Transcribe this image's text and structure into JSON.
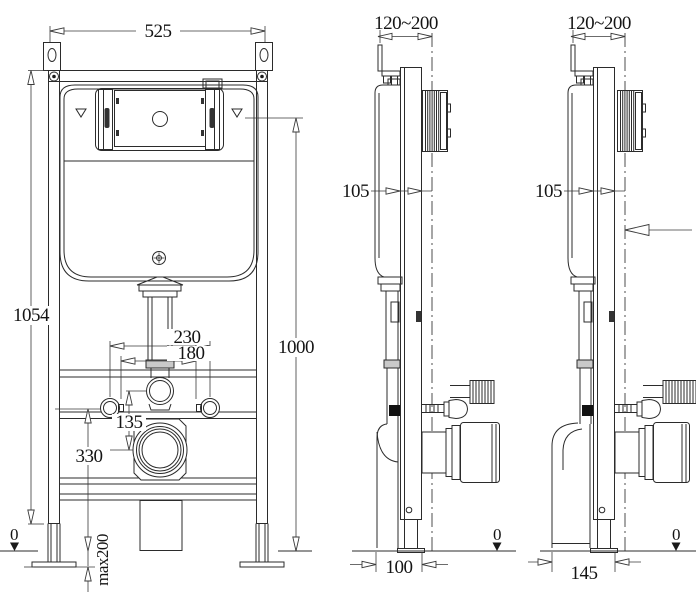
{
  "front_view": {
    "overall_width": "525",
    "frame_height": "1054",
    "panel_axis_height": "1000",
    "bolt_spacing_wide": "230",
    "bolt_spacing_narrow": "180",
    "flush_to_waste_offset": "135",
    "waste_axis_height": "330",
    "floor_marker": "0",
    "foot_adjustment": "max200"
  },
  "side_view_a": {
    "wall_bracket_range": "120~200",
    "frame_depth": "105",
    "outlet_offset": "100",
    "floor_marker": "0"
  },
  "side_view_b": {
    "wall_bracket_range": "120~200",
    "frame_depth": "105",
    "outlet_offset": "145",
    "floor_marker": "0"
  }
}
